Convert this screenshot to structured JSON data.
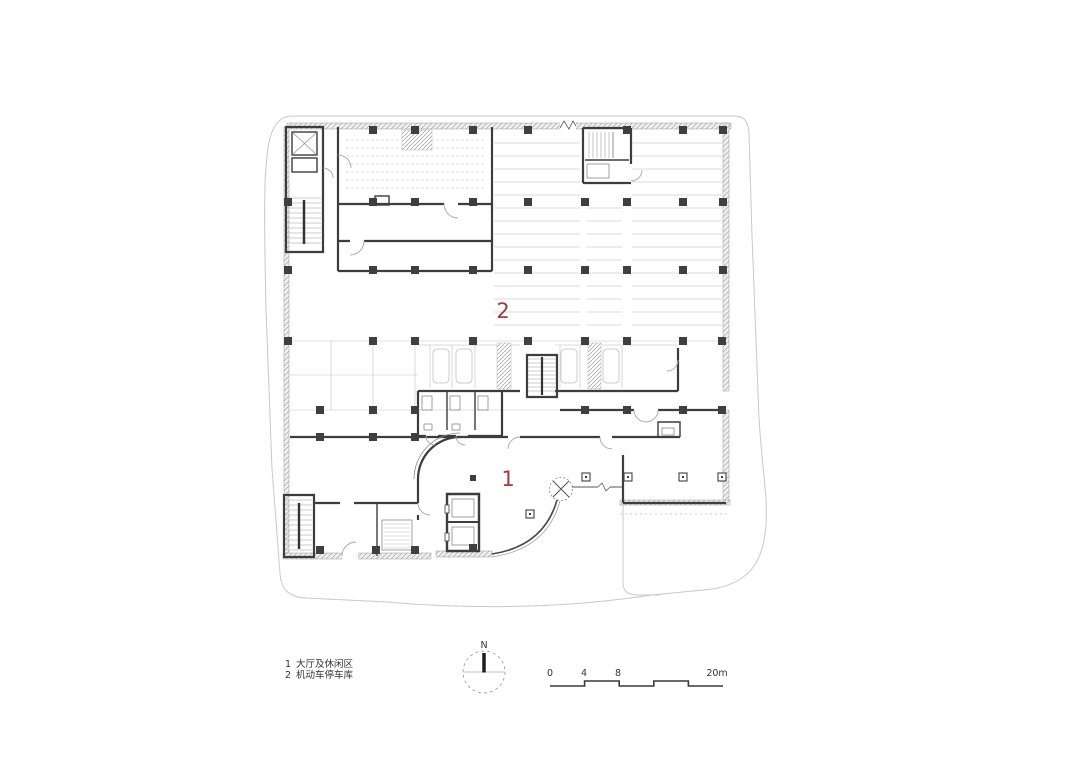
{
  "figure": {
    "type": "architectural floor plan",
    "background": "#ffffff"
  },
  "colors": {
    "accent_red": "#A03B3F",
    "wall_dark": "#3D3D3D",
    "light_line": "#C9C9C9",
    "text_dark": "#333333"
  },
  "plan_labels": [
    {
      "id": "area-2",
      "text": "2"
    },
    {
      "id": "area-1",
      "text": "1"
    }
  ],
  "legend": {
    "items": [
      {
        "num": "1",
        "label": "大厅及休闲区"
      },
      {
        "num": "2",
        "label": "机动车停车库"
      }
    ]
  },
  "north_arrow": {
    "label": "N"
  },
  "scale_bar": {
    "labels": [
      "0",
      "4",
      "8",
      "20m"
    ],
    "unit": "m",
    "total_meters": 20
  }
}
